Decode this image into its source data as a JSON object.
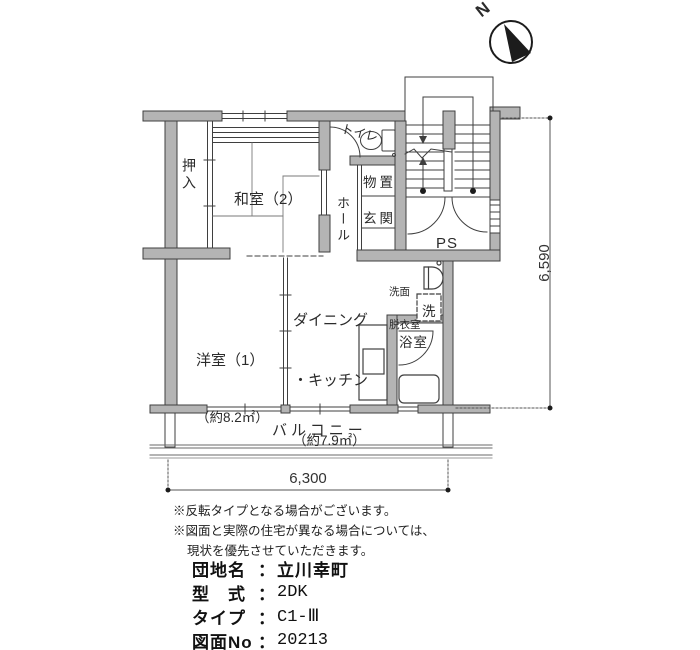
{
  "compass": {
    "north_label": "N"
  },
  "rooms": {
    "oshiire": "押入",
    "washitsu": "和室（2）",
    "hall": "ホール",
    "toilet": "トイレ",
    "storage": "物置",
    "entrance": "玄関",
    "pipe_space": "PS",
    "washroom_line1": "洗面",
    "washroom_line2": "脱衣室",
    "laundry": "洗",
    "bath": "浴室",
    "dk_line1": "ダイニング",
    "dk_line2": "・キッチン",
    "dk_area": "（約7.9㎡）",
    "western_room": "洋室（1）",
    "western_room_area": "（約8.2㎡）",
    "balcony": "バルコニー"
  },
  "dimensions": {
    "width": "6,300",
    "height": "6,590"
  },
  "notes": {
    "line1": "※反転タイプとなる場合がございます。",
    "line2": "※図面と実際の住宅が異なる場合については、",
    "line3": "現状を優先させていただきます。"
  },
  "separator": "：",
  "info": [
    {
      "label": "団地名",
      "value": "立川幸町"
    },
    {
      "label": "型　式",
      "value": "2DK"
    },
    {
      "label": "タイプ",
      "value": "C1-Ⅲ"
    },
    {
      "label": "図面No",
      "value": "20213"
    }
  ]
}
